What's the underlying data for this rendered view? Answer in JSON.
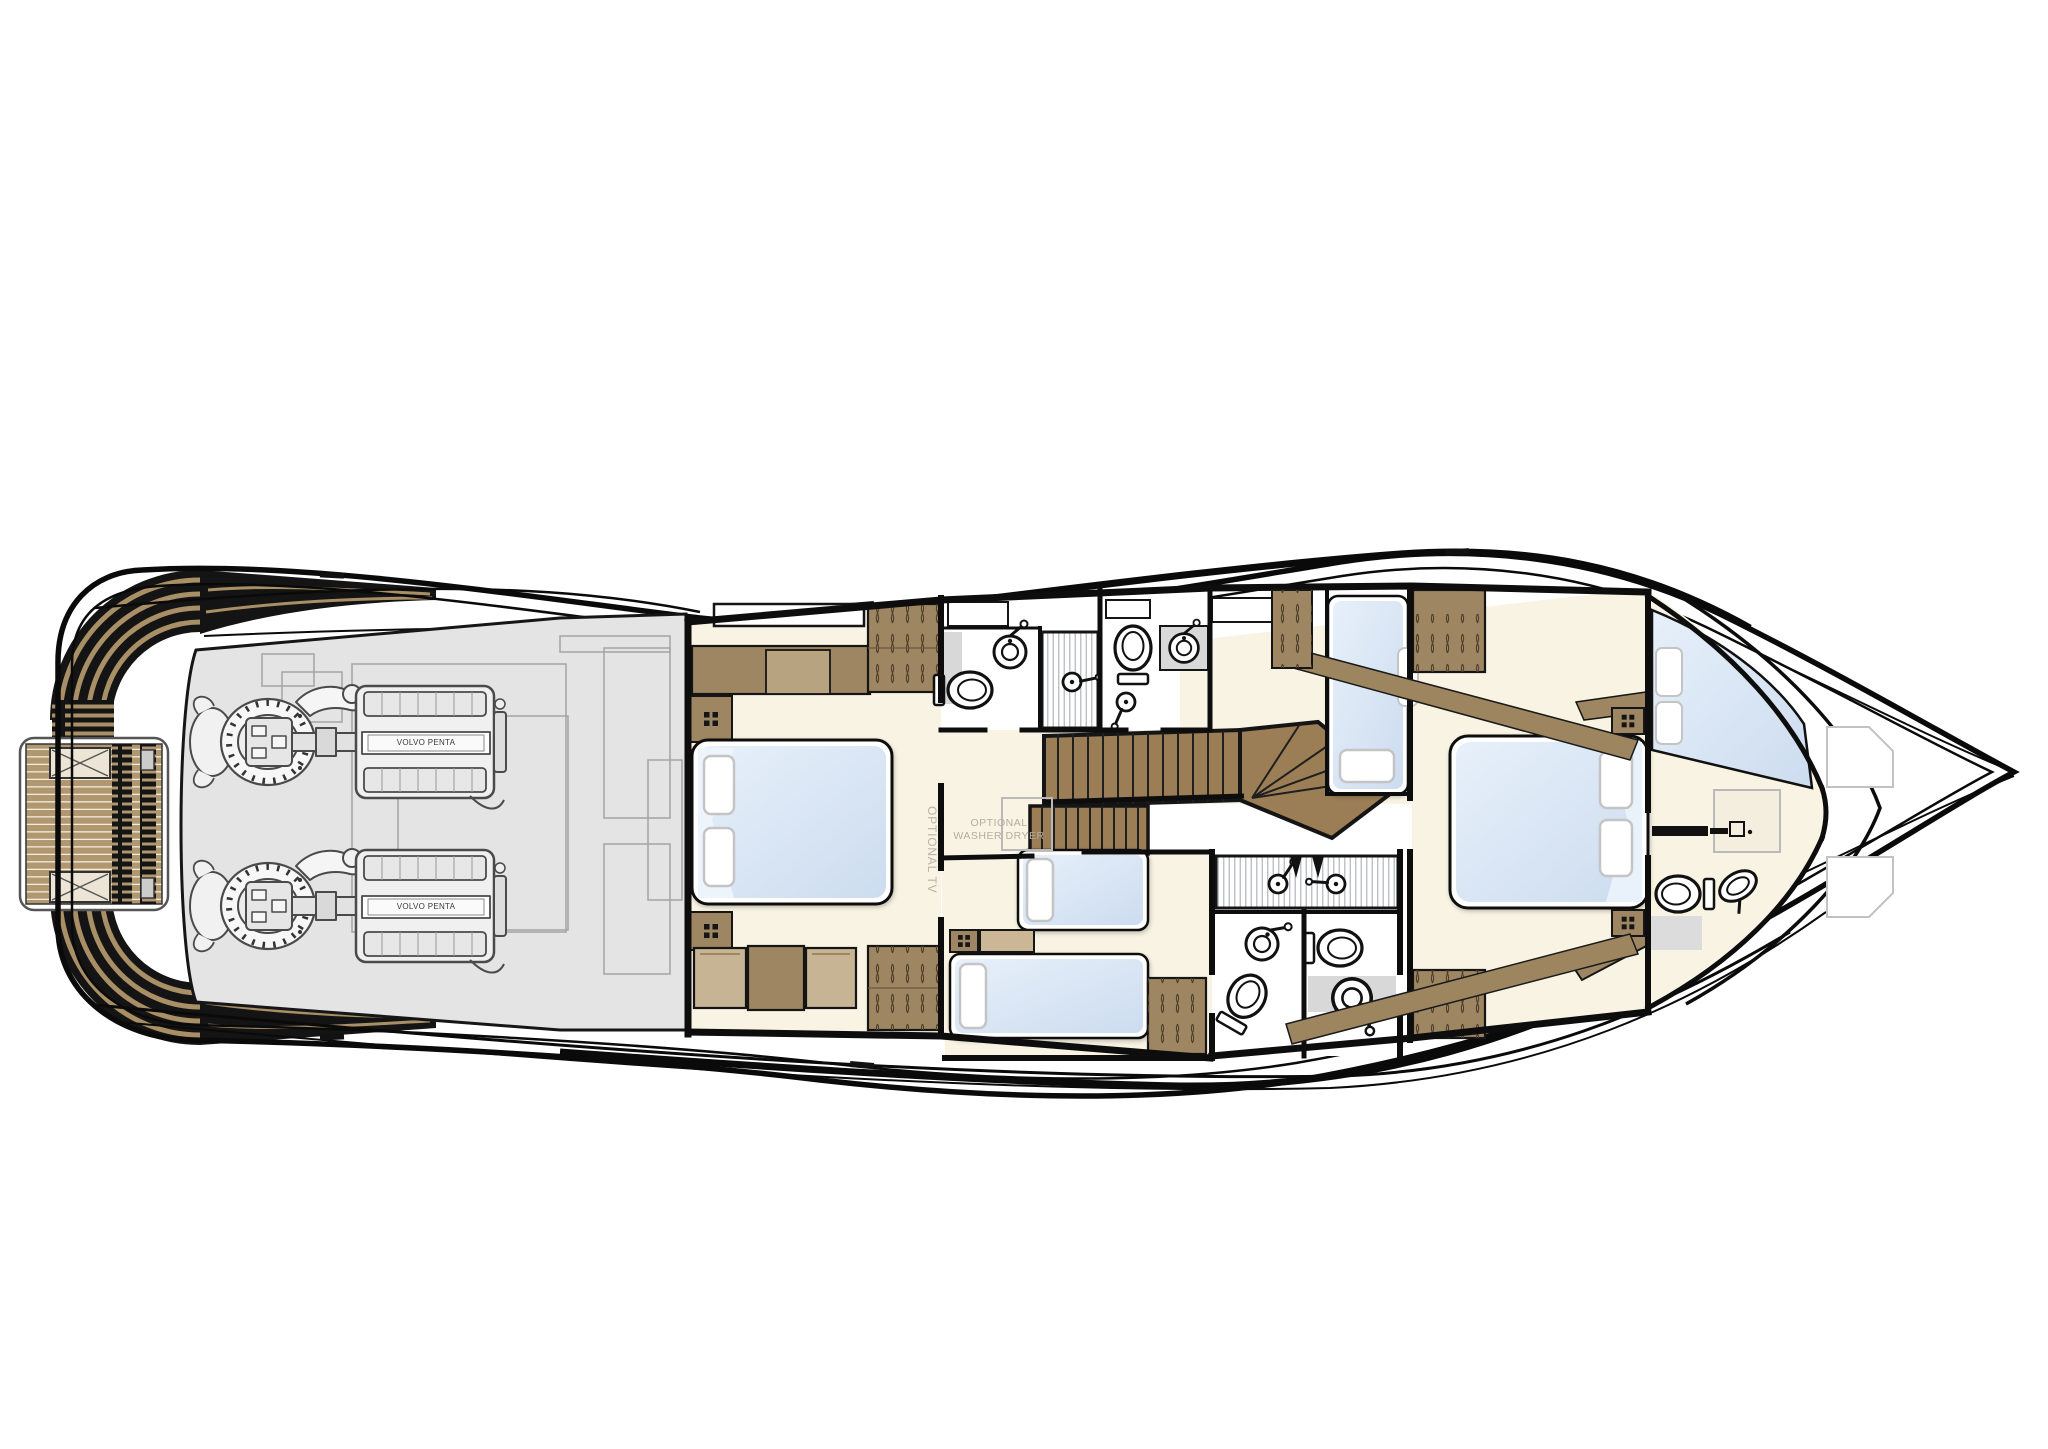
{
  "diagram": {
    "type": "yacht-lower-deck-floor-plan",
    "orientation": "bow-right",
    "labels": {
      "washer_line1": "OPTIONAL",
      "washer_line2": "WASHER DRYER",
      "optional_tv": "OPTIONAL TV",
      "engine_label": "VOLVO PENTA"
    },
    "colors": {
      "outline": "#0c0c0c",
      "teak": "#b09770",
      "teak_stripe": "#a98f66",
      "stair_wood": "#9b7e55",
      "furniture": "#9d8661",
      "furniture_light": "#c6b494",
      "cabin_floor": "#f8f3e2",
      "engine_room_floor": "#e4e4e4",
      "mattress": "#dbe6f4",
      "pillow": "#ffffff",
      "bath_counter": "#d8d8d8",
      "hatch_outline": "#c2c2c2",
      "label_text": "#b3ada3"
    },
    "features": {
      "engines": 2,
      "double_beds": 2,
      "single_beds": 4,
      "toilets": 5,
      "sinks": 5,
      "showers": 2,
      "wardrobes": 6,
      "swim_platform": true,
      "main_staircase": true
    }
  }
}
